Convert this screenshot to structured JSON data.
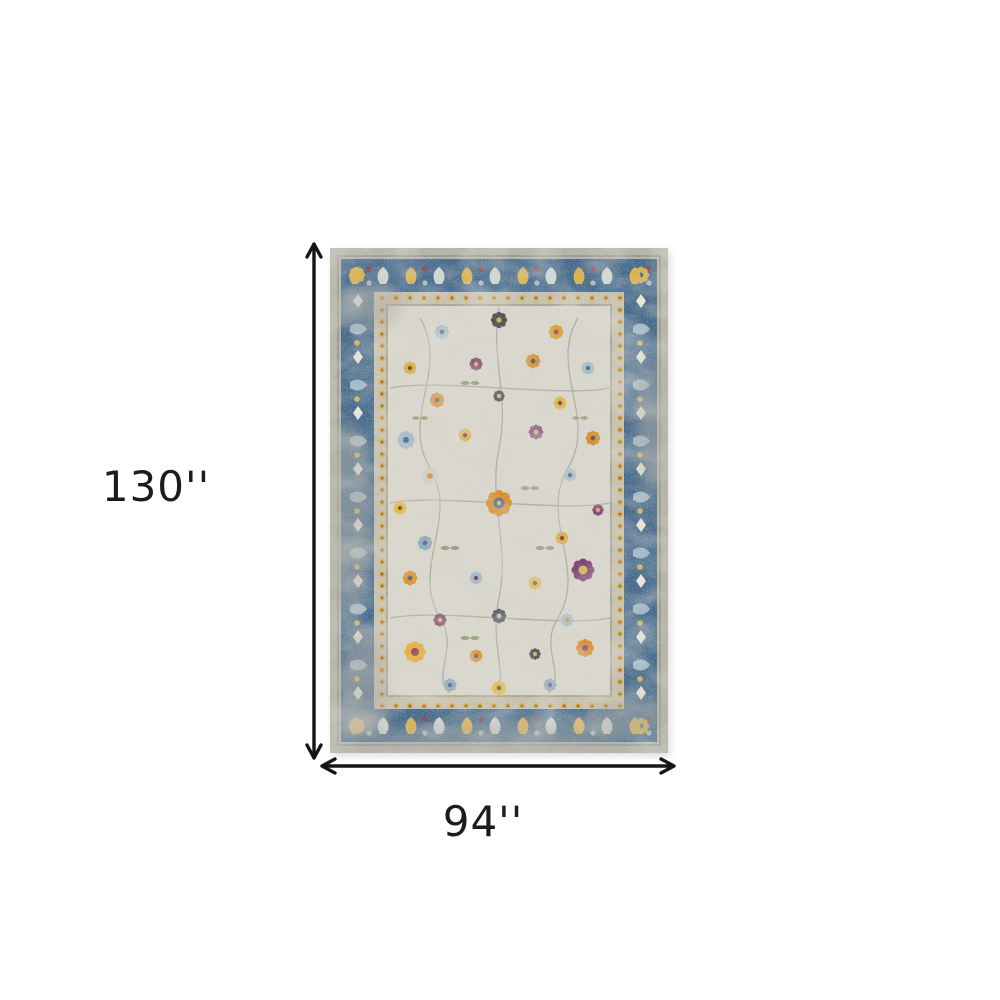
{
  "page": {
    "background": "#ffffff",
    "type": "product-dimension-diagram"
  },
  "diagram": {
    "product": "distressed-oriental-area-rug",
    "height": {
      "label": "130''",
      "value": 130,
      "unit": "inches"
    },
    "width": {
      "label": "94''",
      "value": 94,
      "unit": "inches"
    },
    "arrow_color": "#151515",
    "label_color": "#1c1c1c"
  },
  "rug": {
    "palette": {
      "outer_gray": "#b3b2a8",
      "border_blue": "#44688a",
      "guard_tan": "#c6bfab",
      "field_cream": "#d8d6cb",
      "accent_gold": "#d9b04a",
      "accent_orange": "#d98a25",
      "accent_light_blue": "#a3bcca",
      "accent_purple": "#7b3f6e",
      "accent_slate": "#4a4e55",
      "accent_red": "#8e3b4a",
      "accent_green": "#7d9060",
      "vine_gray": "#a5a399"
    }
  }
}
